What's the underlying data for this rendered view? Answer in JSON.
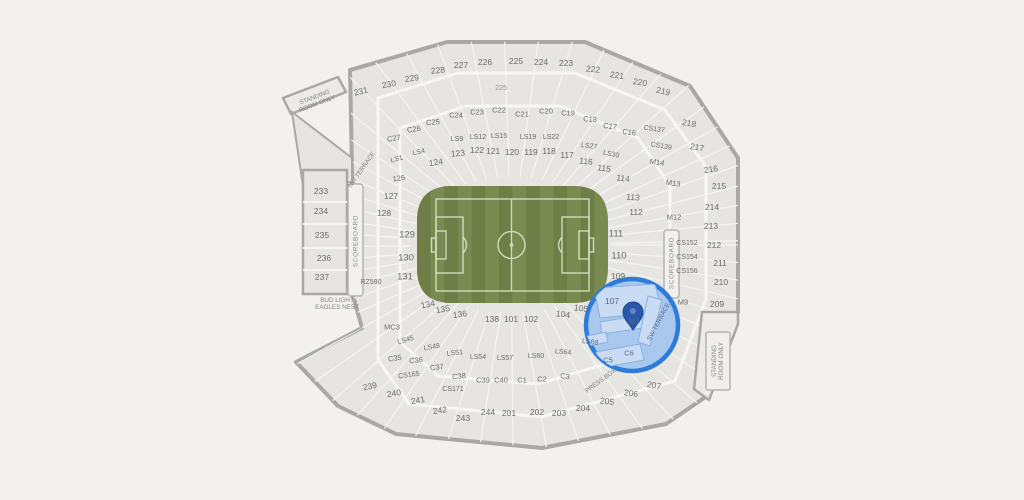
{
  "map": {
    "venue": "stadium-seating-map",
    "colors": {
      "background": "#f2f1ef",
      "section_fill": "#e6e5e2",
      "wall_stroke": "#a9a8a5",
      "walkway": "#f7f6f4",
      "field_dark": "#6d7f46",
      "field_light": "#7a8b51",
      "pitch_line": "#eaf0d8",
      "highlight_stroke": "#2e7cd9",
      "highlight_fill": "#a9c8ed",
      "highlight_section_fill": "#c9dcf4",
      "pin": "#2a57a8",
      "label": "#6c6c69"
    },
    "highlight": {
      "cx": 632,
      "cy": 325,
      "r": 46,
      "pinned_section": "M1"
    },
    "labels": [
      {
        "n": "section-231",
        "t": "231",
        "x": 361,
        "y": 92,
        "r": -14
      },
      {
        "n": "section-230",
        "t": "230",
        "x": 389,
        "y": 85,
        "r": -10
      },
      {
        "n": "section-229",
        "t": "229",
        "x": 412,
        "y": 79,
        "r": -8
      },
      {
        "n": "section-228",
        "t": "228",
        "x": 438,
        "y": 71,
        "r": -5
      },
      {
        "n": "section-227",
        "t": "227",
        "x": 461,
        "y": 66
      },
      {
        "n": "section-226",
        "t": "226",
        "x": 485,
        "y": 63
      },
      {
        "n": "section-225",
        "t": "225",
        "x": 516,
        "y": 62
      },
      {
        "n": "section-224",
        "t": "224",
        "x": 541,
        "y": 63
      },
      {
        "n": "section-223",
        "t": "223",
        "x": 566,
        "y": 64
      },
      {
        "n": "section-222",
        "t": "222",
        "x": 593,
        "y": 70,
        "r": 5
      },
      {
        "n": "section-221",
        "t": "221",
        "x": 617,
        "y": 76,
        "r": 8
      },
      {
        "n": "section-220",
        "t": "220",
        "x": 640,
        "y": 83,
        "r": 10
      },
      {
        "n": "section-219",
        "t": "219",
        "x": 663,
        "y": 92,
        "r": 14
      },
      {
        "n": "tunnel-225",
        "t": "225",
        "x": 501,
        "y": 89,
        "c": "s65 faint",
        "i": false
      },
      {
        "n": "section-c27",
        "t": "C27",
        "x": 394,
        "y": 139,
        "c": "s7",
        "r": -10
      },
      {
        "n": "section-c26",
        "t": "C26",
        "x": 414,
        "y": 130,
        "c": "s7",
        "r": -8
      },
      {
        "n": "section-c25",
        "t": "C25",
        "x": 433,
        "y": 123,
        "c": "s7",
        "r": -5
      },
      {
        "n": "section-c24",
        "t": "C24",
        "x": 456,
        "y": 116,
        "c": "s7"
      },
      {
        "n": "section-c23",
        "t": "C23",
        "x": 477,
        "y": 113,
        "c": "s7"
      },
      {
        "n": "section-c22",
        "t": "C22",
        "x": 499,
        "y": 111,
        "c": "s7"
      },
      {
        "n": "section-c21",
        "t": "C21",
        "x": 522,
        "y": 115,
        "c": "s7"
      },
      {
        "n": "section-c20",
        "t": "C20",
        "x": 546,
        "y": 112,
        "c": "s7"
      },
      {
        "n": "section-c19",
        "t": "C19",
        "x": 568,
        "y": 114,
        "c": "s7"
      },
      {
        "n": "section-c18",
        "t": "C18",
        "x": 590,
        "y": 120,
        "c": "s7",
        "r": 5
      },
      {
        "n": "section-c17",
        "t": "C17",
        "x": 610,
        "y": 127,
        "c": "s7",
        "r": 7
      },
      {
        "n": "section-c16",
        "t": "C16",
        "x": 629,
        "y": 133,
        "c": "s7",
        "r": 8
      },
      {
        "n": "section-cs137",
        "t": "CS137",
        "x": 654,
        "y": 130,
        "c": "s65",
        "r": 8
      },
      {
        "n": "section-cs139",
        "t": "CS139",
        "x": 661,
        "y": 147,
        "c": "s65",
        "r": 10
      },
      {
        "n": "section-ls9",
        "t": "LS9",
        "x": 457,
        "y": 140,
        "c": "s65"
      },
      {
        "n": "section-ls12",
        "t": "LS12",
        "x": 478,
        "y": 138,
        "c": "s65"
      },
      {
        "n": "section-ls15",
        "t": "LS15",
        "x": 499,
        "y": 137,
        "c": "s65"
      },
      {
        "n": "section-ls19",
        "t": "LS19",
        "x": 528,
        "y": 138,
        "c": "s65"
      },
      {
        "n": "section-ls22",
        "t": "LS22",
        "x": 551,
        "y": 138,
        "c": "s65"
      },
      {
        "n": "section-ls27",
        "t": "LS27",
        "x": 589,
        "y": 147,
        "c": "s65",
        "r": 8
      },
      {
        "n": "section-ls30",
        "t": "LS30",
        "x": 611,
        "y": 155,
        "c": "s65",
        "r": 12
      },
      {
        "n": "section-ls4",
        "t": "LS4",
        "x": 419,
        "y": 153,
        "c": "s65",
        "r": -12
      },
      {
        "n": "section-ls1",
        "t": "LS1",
        "x": 397,
        "y": 160,
        "c": "s65",
        "r": -14
      },
      {
        "n": "section-124",
        "t": "124",
        "x": 436,
        "y": 163,
        "r": -8
      },
      {
        "n": "section-123",
        "t": "123",
        "x": 458,
        "y": 154,
        "r": -5
      },
      {
        "n": "section-122",
        "t": "122",
        "x": 477,
        "y": 151
      },
      {
        "n": "section-121",
        "t": "121",
        "x": 493,
        "y": 152
      },
      {
        "n": "section-120",
        "t": "120",
        "x": 512,
        "y": 153
      },
      {
        "n": "section-119",
        "t": "119",
        "x": 531,
        "y": 153
      },
      {
        "n": "section-118",
        "t": "118",
        "x": 549,
        "y": 152
      },
      {
        "n": "section-117",
        "t": "117",
        "x": 567,
        "y": 156
      },
      {
        "n": "section-116",
        "t": "116",
        "x": 586,
        "y": 162,
        "r": 6
      },
      {
        "n": "section-115",
        "t": "115",
        "x": 604,
        "y": 169,
        "r": 8
      },
      {
        "n": "section-114",
        "t": "114",
        "x": 623,
        "y": 179,
        "r": 8
      },
      {
        "n": "section-113",
        "t": "113",
        "x": 633,
        "y": 198,
        "r": 5
      },
      {
        "n": "section-112",
        "t": "112",
        "x": 636,
        "y": 213
      },
      {
        "n": "section-126",
        "t": "126",
        "x": 399,
        "y": 179,
        "c": "s7",
        "r": -8
      },
      {
        "n": "section-127",
        "t": "127",
        "x": 391,
        "y": 197
      },
      {
        "n": "section-128",
        "t": "128",
        "x": 384,
        "y": 214
      },
      {
        "n": "section-129",
        "t": "129",
        "x": 407,
        "y": 236,
        "c": "s9"
      },
      {
        "n": "section-130",
        "t": "130",
        "x": 406,
        "y": 259,
        "c": "s9"
      },
      {
        "n": "section-131",
        "t": "131",
        "x": 405,
        "y": 278,
        "c": "s9"
      },
      {
        "n": "section-rz590",
        "t": "RZ590",
        "x": 371,
        "y": 283,
        "c": "s65"
      },
      {
        "n": "section-111",
        "t": "111",
        "x": 616,
        "y": 235,
        "c": "s9"
      },
      {
        "n": "section-110",
        "t": "110",
        "x": 619,
        "y": 257,
        "c": "s9"
      },
      {
        "n": "section-109",
        "t": "109",
        "x": 618,
        "y": 277
      },
      {
        "n": "section-107",
        "t": "107",
        "x": 612,
        "y": 302,
        "c": "s8 blue"
      },
      {
        "n": "section-105",
        "t": "105",
        "x": 581,
        "y": 309,
        "r": 8
      },
      {
        "n": "section-104",
        "t": "104",
        "x": 563,
        "y": 315,
        "r": 8
      },
      {
        "n": "section-102",
        "t": "102",
        "x": 531,
        "y": 320
      },
      {
        "n": "section-101",
        "t": "101",
        "x": 511,
        "y": 320
      },
      {
        "n": "section-138",
        "t": "138",
        "x": 492,
        "y": 320
      },
      {
        "n": "section-136",
        "t": "136",
        "x": 460,
        "y": 315,
        "r": -8
      },
      {
        "n": "section-135",
        "t": "135",
        "x": 443,
        "y": 310,
        "r": -10
      },
      {
        "n": "section-134",
        "t": "134",
        "x": 428,
        "y": 305,
        "r": -12
      },
      {
        "n": "section-m14",
        "t": "M14",
        "x": 657,
        "y": 163,
        "c": "s7",
        "r": 8
      },
      {
        "n": "section-m13",
        "t": "M13",
        "x": 673,
        "y": 184,
        "c": "s7",
        "r": 8
      },
      {
        "n": "section-m12",
        "t": "M12",
        "x": 674,
        "y": 218,
        "c": "s7"
      },
      {
        "n": "section-m9",
        "t": "M9",
        "x": 683,
        "y": 303,
        "c": "s7"
      },
      {
        "n": "section-cs152",
        "t": "CS152",
        "x": 687,
        "y": 244,
        "c": "s65"
      },
      {
        "n": "section-cs154",
        "t": "CS154",
        "x": 687,
        "y": 258,
        "c": "s65"
      },
      {
        "n": "section-cs156",
        "t": "CS156",
        "x": 687,
        "y": 272,
        "c": "s65"
      },
      {
        "n": "section-218",
        "t": "218",
        "x": 689,
        "y": 124,
        "r": 10
      },
      {
        "n": "section-217",
        "t": "217",
        "x": 697,
        "y": 148,
        "r": 10
      },
      {
        "n": "section-216",
        "t": "216",
        "x": 711,
        "y": 170,
        "r": -8
      },
      {
        "n": "section-215",
        "t": "215",
        "x": 719,
        "y": 187
      },
      {
        "n": "section-214",
        "t": "214",
        "x": 712,
        "y": 208
      },
      {
        "n": "section-213",
        "t": "213",
        "x": 711,
        "y": 227
      },
      {
        "n": "section-212",
        "t": "212",
        "x": 714,
        "y": 246
      },
      {
        "n": "section-211",
        "t": "211",
        "x": 720,
        "y": 264
      },
      {
        "n": "section-210",
        "t": "210",
        "x": 721,
        "y": 283
      },
      {
        "n": "section-209",
        "t": "209",
        "x": 717,
        "y": 305
      },
      {
        "n": "section-233",
        "t": "233",
        "x": 321,
        "y": 192
      },
      {
        "n": "section-234",
        "t": "234",
        "x": 321,
        "y": 212
      },
      {
        "n": "section-235",
        "t": "235",
        "x": 322,
        "y": 236
      },
      {
        "n": "section-236",
        "t": "236",
        "x": 324,
        "y": 259
      },
      {
        "n": "section-237",
        "t": "237",
        "x": 322,
        "y": 278
      },
      {
        "n": "section-mc3",
        "t": "MC3",
        "x": 392,
        "y": 328,
        "c": "s7"
      },
      {
        "n": "section-ls45",
        "t": "LS45",
        "x": 406,
        "y": 341,
        "c": "s65",
        "r": -16
      },
      {
        "n": "section-ls48",
        "t": "LS48",
        "x": 432,
        "y": 348,
        "c": "s65",
        "r": -10
      },
      {
        "n": "section-ls51",
        "t": "LS51",
        "x": 455,
        "y": 354,
        "c": "s65",
        "r": -6
      },
      {
        "n": "section-ls54",
        "t": "LS54",
        "x": 478,
        "y": 358,
        "c": "s65"
      },
      {
        "n": "section-ls57",
        "t": "LS57",
        "x": 505,
        "y": 359,
        "c": "s65"
      },
      {
        "n": "section-ls60",
        "t": "LS60",
        "x": 536,
        "y": 357,
        "c": "s65"
      },
      {
        "n": "section-ls64",
        "t": "LS64",
        "x": 563,
        "y": 353,
        "c": "s65",
        "r": 6
      },
      {
        "n": "section-ls68",
        "t": "LS68",
        "x": 590,
        "y": 343,
        "c": "s65 blue",
        "r": 8
      },
      {
        "n": "section-c35",
        "t": "C35",
        "x": 395,
        "y": 359,
        "c": "s7",
        "r": -8
      },
      {
        "n": "section-c36",
        "t": "C36",
        "x": 416,
        "y": 361,
        "c": "s7",
        "r": -6
      },
      {
        "n": "section-c37",
        "t": "C37",
        "x": 437,
        "y": 368,
        "c": "s7",
        "r": -8
      },
      {
        "n": "section-c38",
        "t": "C38",
        "x": 459,
        "y": 377,
        "c": "s7",
        "r": -6
      },
      {
        "n": "section-c39",
        "t": "C39",
        "x": 483,
        "y": 381,
        "c": "s7"
      },
      {
        "n": "section-c40",
        "t": "C40",
        "x": 501,
        "y": 381,
        "c": "s7"
      },
      {
        "n": "section-c1",
        "t": "C1",
        "x": 522,
        "y": 381,
        "c": "s7"
      },
      {
        "n": "section-c2",
        "t": "C2",
        "x": 542,
        "y": 380,
        "c": "s7"
      },
      {
        "n": "section-c3",
        "t": "C3",
        "x": 565,
        "y": 377,
        "c": "s7",
        "r": 8
      },
      {
        "n": "section-c5",
        "t": "C5",
        "x": 608,
        "y": 361,
        "c": "s7 blue"
      },
      {
        "n": "section-c6",
        "t": "C6",
        "x": 629,
        "y": 354,
        "c": "s7 blue"
      },
      {
        "n": "section-cs165",
        "t": "CS165",
        "x": 409,
        "y": 376,
        "c": "s65",
        "r": -8
      },
      {
        "n": "section-cs171",
        "t": "CS171",
        "x": 453,
        "y": 390,
        "c": "s65"
      },
      {
        "n": "section-239",
        "t": "239",
        "x": 370,
        "y": 387,
        "r": -12
      },
      {
        "n": "section-240",
        "t": "240",
        "x": 394,
        "y": 394,
        "r": -10
      },
      {
        "n": "section-241",
        "t": "241",
        "x": 418,
        "y": 401,
        "r": -10
      },
      {
        "n": "section-242",
        "t": "242",
        "x": 440,
        "y": 411,
        "r": -8
      },
      {
        "n": "section-243",
        "t": "243",
        "x": 463,
        "y": 419
      },
      {
        "n": "section-244",
        "t": "244",
        "x": 488,
        "y": 413
      },
      {
        "n": "section-201",
        "t": "201",
        "x": 509,
        "y": 414
      },
      {
        "n": "section-202",
        "t": "202",
        "x": 537,
        "y": 413
      },
      {
        "n": "section-203",
        "t": "203",
        "x": 559,
        "y": 414
      },
      {
        "n": "section-204",
        "t": "204",
        "x": 583,
        "y": 409
      },
      {
        "n": "section-205",
        "t": "205",
        "x": 607,
        "y": 402,
        "r": 6
      },
      {
        "n": "section-206",
        "t": "206",
        "x": 631,
        "y": 394,
        "r": 8
      },
      {
        "n": "section-207",
        "t": "207",
        "x": 654,
        "y": 386,
        "r": 10
      },
      {
        "n": "section-m1",
        "t": "M1",
        "x": 634,
        "y": 322,
        "c": "s7 blue"
      },
      {
        "n": "standing-room-nw",
        "lines": [
          "STANDING",
          "ROOM ONLY"
        ],
        "x": 316,
        "y": 101,
        "r": -21,
        "c": "tiny"
      },
      {
        "n": "standing-room-se",
        "lines": [
          "STANDING",
          "ROOM ONLY"
        ],
        "x": 718,
        "y": 361,
        "r": -90,
        "c": "tiny"
      },
      {
        "n": "scoreboard-west",
        "t": "SCOREBOARD",
        "x": 356,
        "y": 241,
        "r": -90,
        "c": "tiny ls",
        "i": false
      },
      {
        "n": "scoreboard-east",
        "t": "SCOREBOARD",
        "x": 672,
        "y": 263,
        "r": -90,
        "c": "tiny ls",
        "i": false
      },
      {
        "n": "bud-light-eagles-nest",
        "lines": [
          "BUD LIGHT",
          "EAGLES NEST"
        ],
        "x": 337,
        "y": 304,
        "c": "tiny"
      },
      {
        "n": "press-box",
        "t": "PRESS BOX",
        "x": 601,
        "y": 381,
        "r": -36,
        "c": "tiny"
      },
      {
        "n": "nw-terrace",
        "t": "NW TERRACE",
        "x": 362,
        "y": 170,
        "r": -55,
        "c": "tiny"
      },
      {
        "n": "sw-terrace",
        "t": "SW TERRACE",
        "x": 659,
        "y": 322,
        "r": -62,
        "c": "tiny blue"
      }
    ]
  }
}
